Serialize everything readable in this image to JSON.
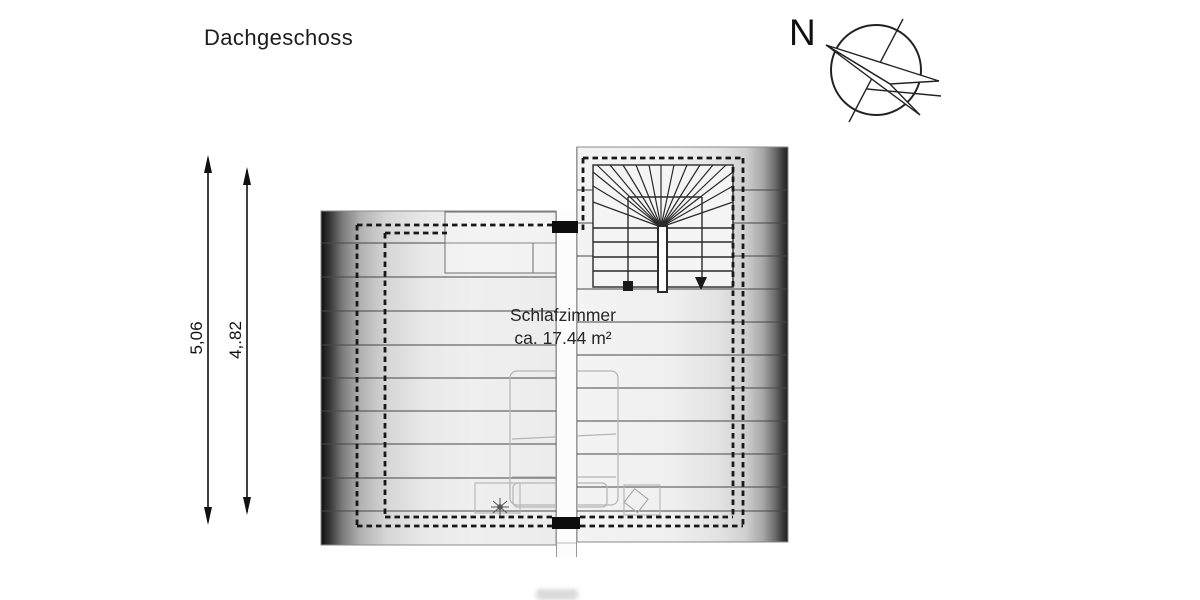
{
  "title": "Dachgeschoss",
  "compass": {
    "label": "N",
    "icon": "compass-north-arrow-icon"
  },
  "dimensions": {
    "outer": "5,06",
    "inner": "4,.82"
  },
  "room": {
    "name": "Schlafzimmer",
    "area": "ca. 17.44 m²"
  },
  "palette": {
    "background": "#ffffff",
    "line_dark": "#1a1a1a",
    "roof_line": "#474747",
    "furniture_line": "#b4b4b4",
    "roof_shade_dark": "#101010",
    "roof_shade_light": "#f1f1f1"
  }
}
